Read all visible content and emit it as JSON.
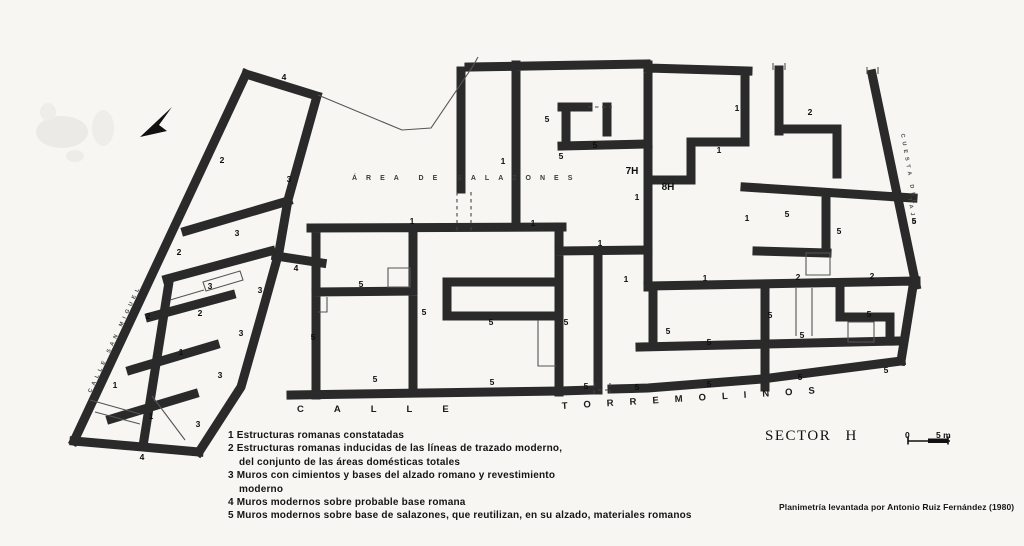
{
  "title": {
    "sector": "SECTOR H",
    "attribution": "Planimetría levantada por Antonio Ruiz Fernández (1980)"
  },
  "streets": {
    "calle": "CALLE",
    "torremolinos": "TORREMOLINOS",
    "area_salazones": "ÁREA DE SALAZONES",
    "left_street": "CALLE SAN MIGUEL",
    "right_street_upper": "CUESTA DEL",
    "right_street_lower": "TAJO"
  },
  "scale_bar": {
    "start": "0",
    "end": "5 m"
  },
  "legend": {
    "lines": [
      {
        "text": "1 Estructuras romanas constatadas",
        "indent": false
      },
      {
        "text": "2 Estructuras romanas inducidas de las líneas de trazado moderno,",
        "indent": false
      },
      {
        "text": "del conjunto de las áreas domésticas totales",
        "indent": true
      },
      {
        "text": "3 Muros con cimientos y bases del alzado romano y revestimiento",
        "indent": false
      },
      {
        "text": "moderno",
        "indent": true
      },
      {
        "text": "4 Muros modernos sobre probable base romana",
        "indent": false
      },
      {
        "text": "5 Muros modernos sobre base de salazones, que reutilizan, en su alzado, materiales romanos",
        "indent": false
      }
    ]
  },
  "plan": {
    "grid_refs": [
      "7H",
      "8H"
    ],
    "labels": [
      {
        "t": "4",
        "x": 284,
        "y": 80
      },
      {
        "t": "2",
        "x": 222,
        "y": 163
      },
      {
        "t": "3",
        "x": 289,
        "y": 182
      },
      {
        "t": "3",
        "x": 237,
        "y": 236
      },
      {
        "t": "2",
        "x": 179,
        "y": 255
      },
      {
        "t": "4",
        "x": 296,
        "y": 271
      },
      {
        "t": "3",
        "x": 210,
        "y": 289
      },
      {
        "t": "3",
        "x": 260,
        "y": 293
      },
      {
        "t": "2",
        "x": 148,
        "y": 319
      },
      {
        "t": "2",
        "x": 200,
        "y": 316
      },
      {
        "t": "3",
        "x": 241,
        "y": 336
      },
      {
        "t": "1",
        "x": 181,
        "y": 355
      },
      {
        "t": "3",
        "x": 220,
        "y": 378
      },
      {
        "t": "1",
        "x": 115,
        "y": 388
      },
      {
        "t": "1",
        "x": 151,
        "y": 419
      },
      {
        "t": "3",
        "x": 198,
        "y": 427
      },
      {
        "t": "4",
        "x": 142,
        "y": 460
      },
      {
        "t": "1",
        "x": 503,
        "y": 164
      },
      {
        "t": "5",
        "x": 547,
        "y": 122
      },
      {
        "t": "5",
        "x": 595,
        "y": 148
      },
      {
        "t": "5",
        "x": 561,
        "y": 159
      },
      {
        "t": "7H",
        "x": 632,
        "y": 174
      },
      {
        "t": "1",
        "x": 637,
        "y": 200
      },
      {
        "t": "1",
        "x": 412,
        "y": 224
      },
      {
        "t": "1",
        "x": 533,
        "y": 226
      },
      {
        "t": "1",
        "x": 737,
        "y": 111
      },
      {
        "t": "2",
        "x": 810,
        "y": 115
      },
      {
        "t": "1",
        "x": 719,
        "y": 153
      },
      {
        "t": "8H",
        "x": 668,
        "y": 190
      },
      {
        "t": "5",
        "x": 787,
        "y": 217
      },
      {
        "t": "1",
        "x": 747,
        "y": 221
      },
      {
        "t": "5",
        "x": 839,
        "y": 234
      },
      {
        "t": "5",
        "x": 914,
        "y": 224
      },
      {
        "t": "1",
        "x": 600,
        "y": 246
      },
      {
        "t": "1",
        "x": 626,
        "y": 282
      },
      {
        "t": "1",
        "x": 705,
        "y": 281
      },
      {
        "t": "2",
        "x": 798,
        "y": 280
      },
      {
        "t": "2",
        "x": 872,
        "y": 279
      },
      {
        "t": "5",
        "x": 361,
        "y": 287
      },
      {
        "t": "5",
        "x": 424,
        "y": 315
      },
      {
        "t": "5",
        "x": 313,
        "y": 340
      },
      {
        "t": "5",
        "x": 491,
        "y": 325
      },
      {
        "t": "5",
        "x": 566,
        "y": 325
      },
      {
        "t": "5",
        "x": 375,
        "y": 382
      },
      {
        "t": "5",
        "x": 492,
        "y": 385
      },
      {
        "t": "5",
        "x": 586,
        "y": 389
      },
      {
        "t": "5",
        "x": 637,
        "y": 390
      },
      {
        "t": "5",
        "x": 668,
        "y": 334
      },
      {
        "t": "5",
        "x": 709,
        "y": 345
      },
      {
        "t": "5",
        "x": 770,
        "y": 318
      },
      {
        "t": "5",
        "x": 802,
        "y": 338
      },
      {
        "t": "5",
        "x": 869,
        "y": 317
      },
      {
        "t": "5",
        "x": 886,
        "y": 373
      },
      {
        "t": "5",
        "x": 800,
        "y": 380
      },
      {
        "t": "5",
        "x": 709,
        "y": 387
      }
    ]
  },
  "colors": {
    "wall": "#2a2a2a",
    "paper": "#f7f6f3",
    "ink": "#141414"
  }
}
